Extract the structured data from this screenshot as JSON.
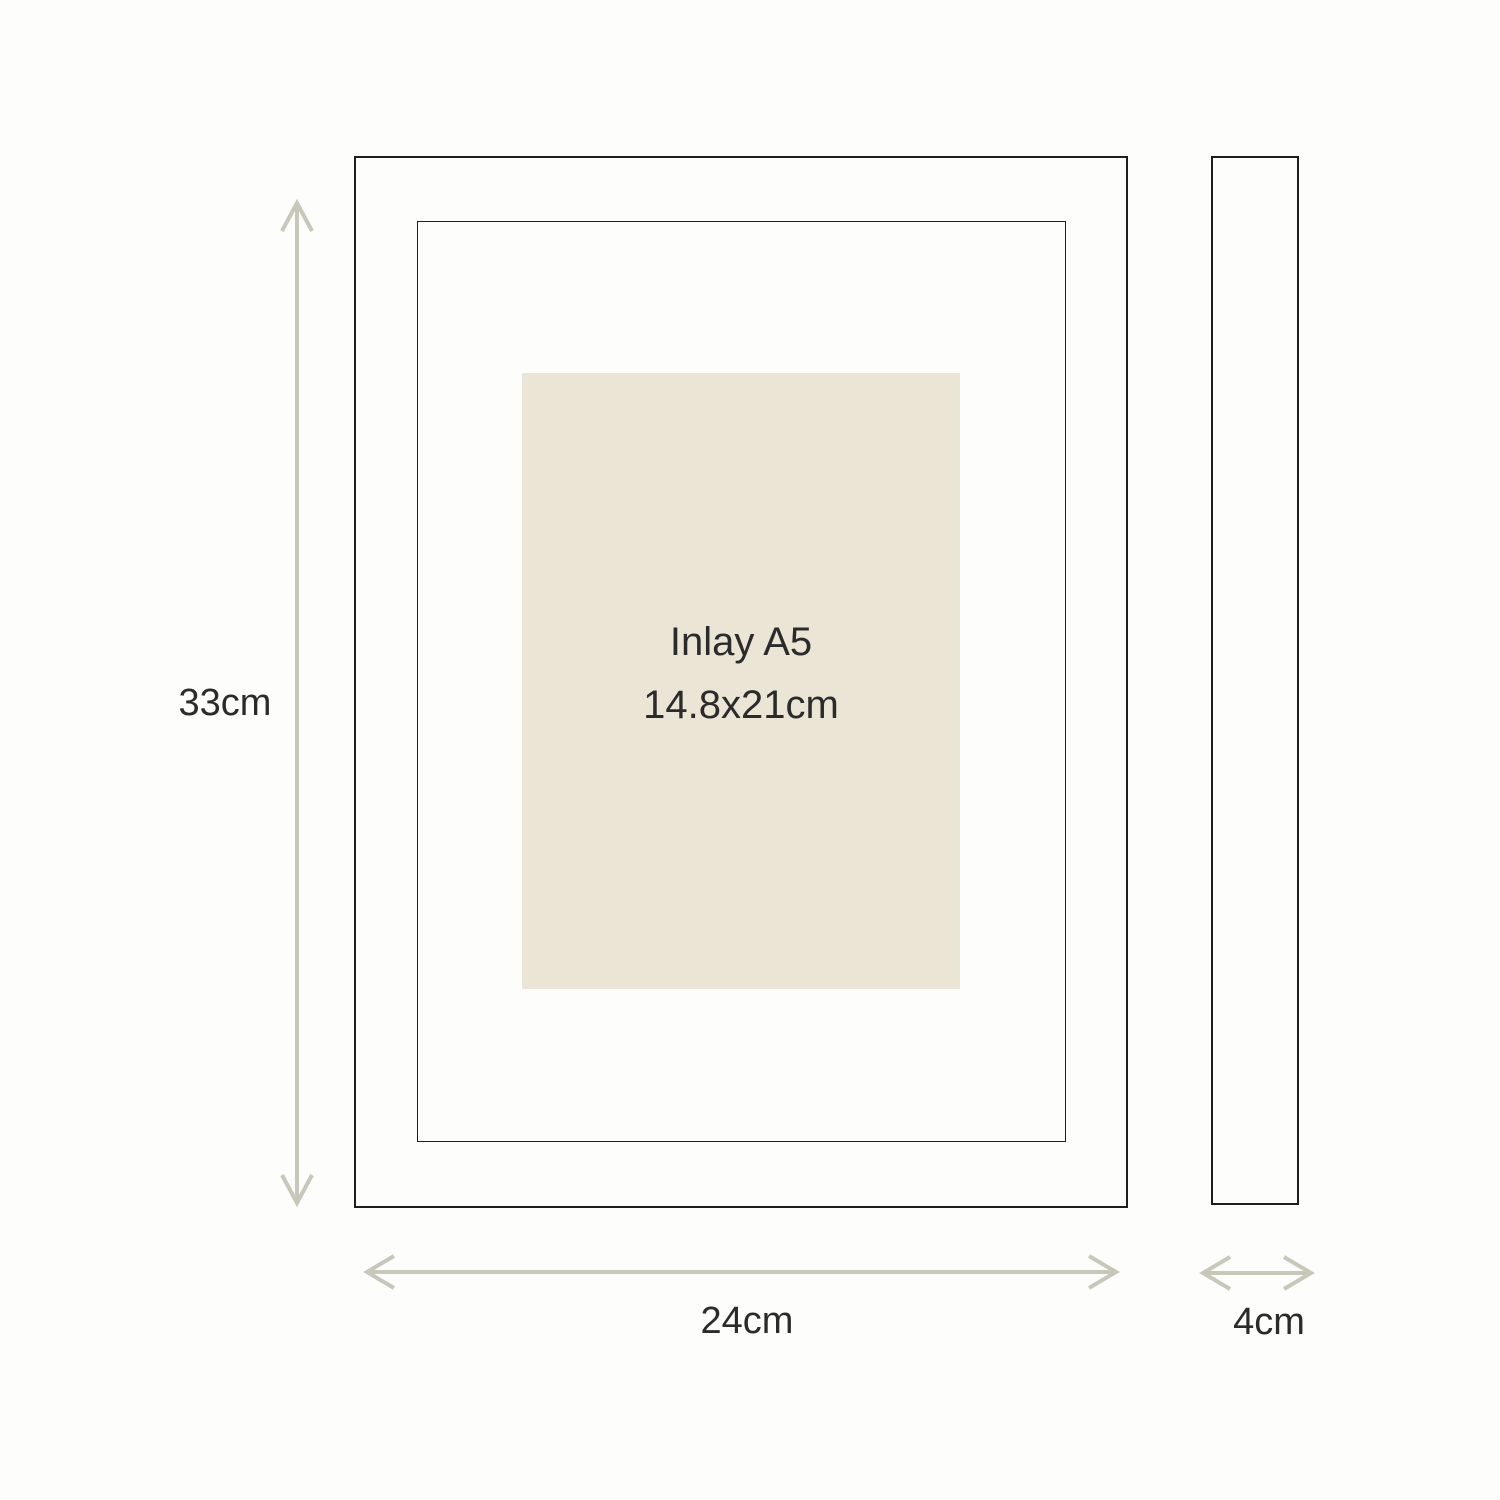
{
  "diagram": {
    "front_view": {
      "inlay": {
        "title": "Inlay A5",
        "size": "14.8x21cm"
      }
    },
    "dimensions": {
      "height": "33cm",
      "width": "24cm",
      "depth": "4cm"
    }
  },
  "icons": {
    "height_arrow": "vertical-double-arrow",
    "width_arrow": "horizontal-double-arrow",
    "depth_arrow": "horizontal-double-arrow"
  },
  "colors": {
    "arrow": "#c7c8ba",
    "inlay-fill": "#eae5d4",
    "line": "#1e1e1e",
    "text": "#2b2b2b",
    "background": "#fdfdfc"
  }
}
